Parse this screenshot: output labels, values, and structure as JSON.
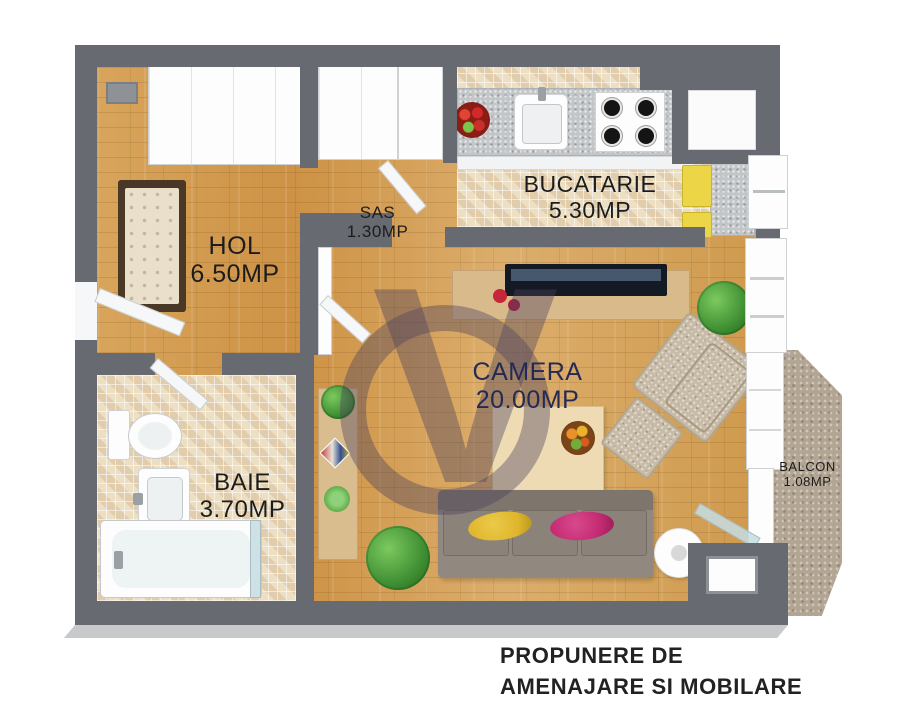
{
  "plan": {
    "type": "apartment-floor-plan-3d",
    "rooms": [
      {
        "name": "HOL",
        "area": "6.50MP"
      },
      {
        "name": "SAS",
        "area": "1.30MP"
      },
      {
        "name": "BUCATARIE",
        "area": "5.30MP"
      },
      {
        "name": "CAMERA",
        "area": "20.00MP"
      },
      {
        "name": "BAIE",
        "area": "3.70MP"
      },
      {
        "name": "BALCON",
        "area": "1.08MP"
      }
    ]
  },
  "title": {
    "line1": "PROPUNERE DE",
    "line2": "AMENAJARE SI MOBILARE"
  },
  "watermark": {
    "glyph": "V"
  },
  "colors": {
    "wall": "#676b71",
    "wood_floor": "#d29a4f",
    "mosaic_tile": "#ecdfc4",
    "balcony_stone": "#b3a593",
    "kitchen_accent_yellow": "#ecd546",
    "sofa": "#8b8379",
    "pillow_yellow": "#dfb62c",
    "pillow_magenta": "#c42a72",
    "plant_green": "#3f8f33",
    "label_text": "#1c1c1c",
    "camera_label_text": "#232a55",
    "title_text": "#222222",
    "watermark": "#4a425c"
  }
}
